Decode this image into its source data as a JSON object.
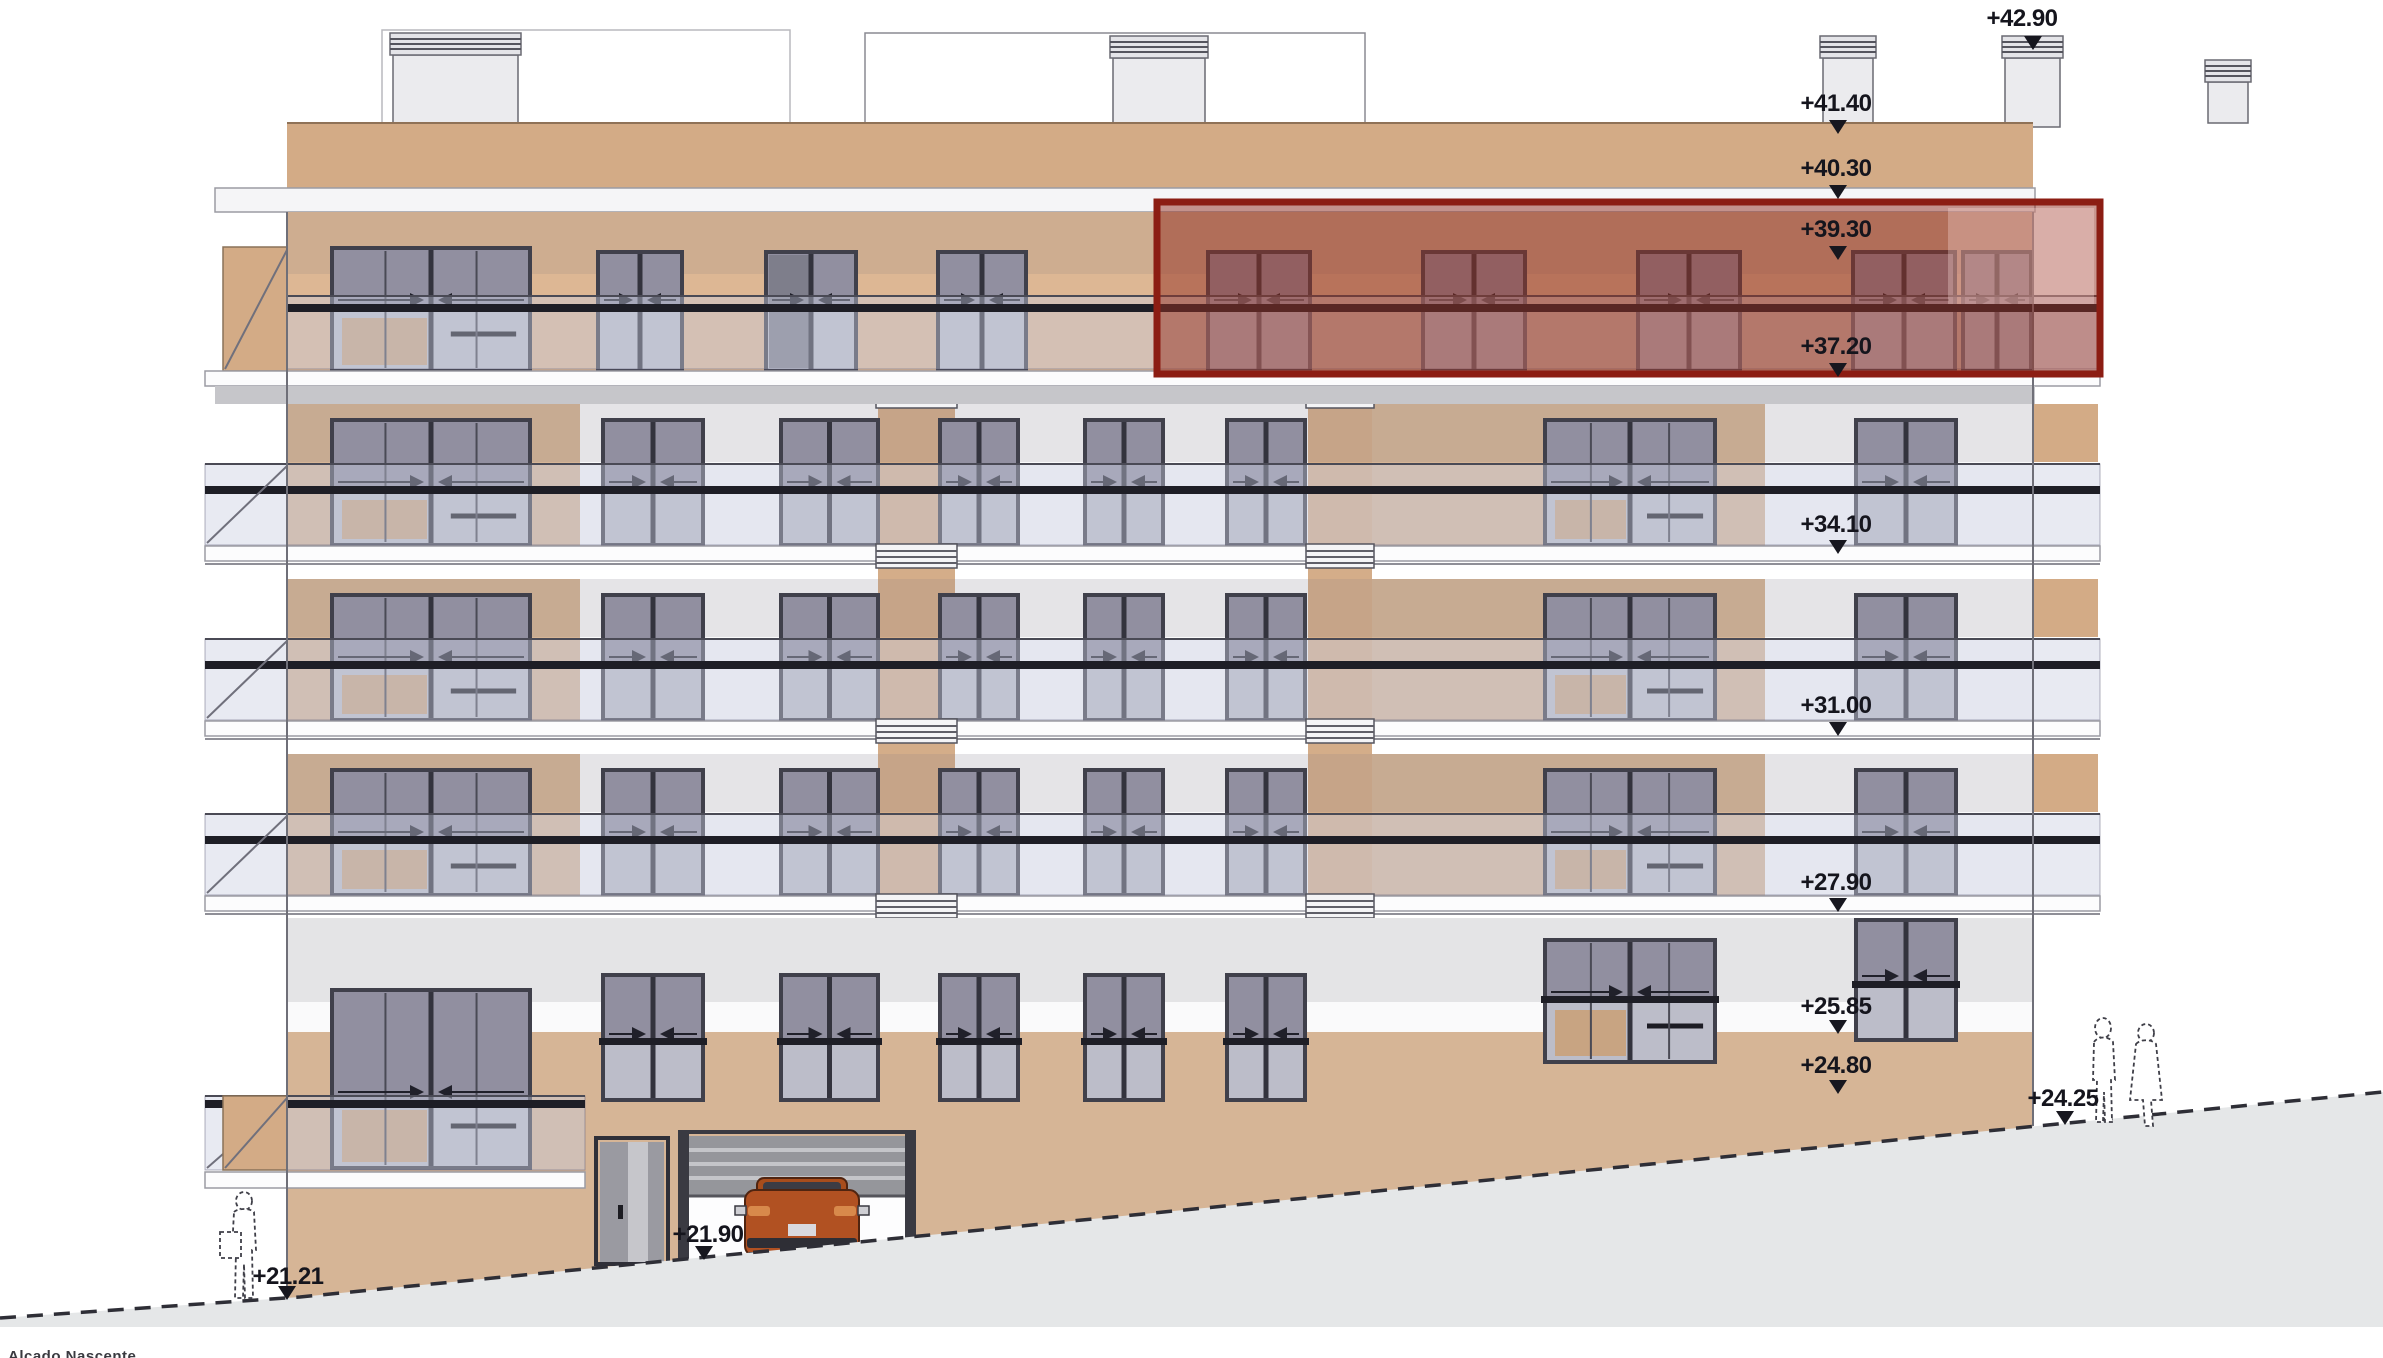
{
  "drawing": {
    "title": "Alçado Nascente"
  },
  "elevation_markers": {
    "labels": [
      "+42.90",
      "+41.40",
      "+40.30",
      "+39.30",
      "+37.20",
      "+34.10",
      "+31.00",
      "+27.90",
      "+25.85",
      "+24.80",
      "+24.25",
      "+21.90",
      "+21.21"
    ]
  },
  "highlight": {
    "border_color": "#8c1d13",
    "fill_color": "rgba(148,47,33,0.50)"
  },
  "palette": {
    "facade_tan": "#d6b596",
    "attic_tan": "#d3ab86",
    "pier_tan": "#d4ad89",
    "wall_white": "#fafafb",
    "band_gray": "#e4e4e6",
    "slab_white": "#fcfcfd",
    "slab_edge": "#9b9ba3",
    "fascia_gray": "#c6c6ca",
    "glass_dark": "#918fa0",
    "glass_light": "#bcbdc9",
    "frame_dark": "#40404b",
    "rail_dark": "#1e1e26",
    "railing_glass": "rgba(199,204,223,0.42)",
    "ground_gray": "#e5e7e8",
    "ground_line": "#2e2e36",
    "car_orange": "#b15122",
    "interior_tan": "#c8a482"
  },
  "figures": {
    "left_figure": "person-silhouette",
    "right_figures": "two-person-silhouettes",
    "vehicle": "car-rear-silhouette"
  }
}
